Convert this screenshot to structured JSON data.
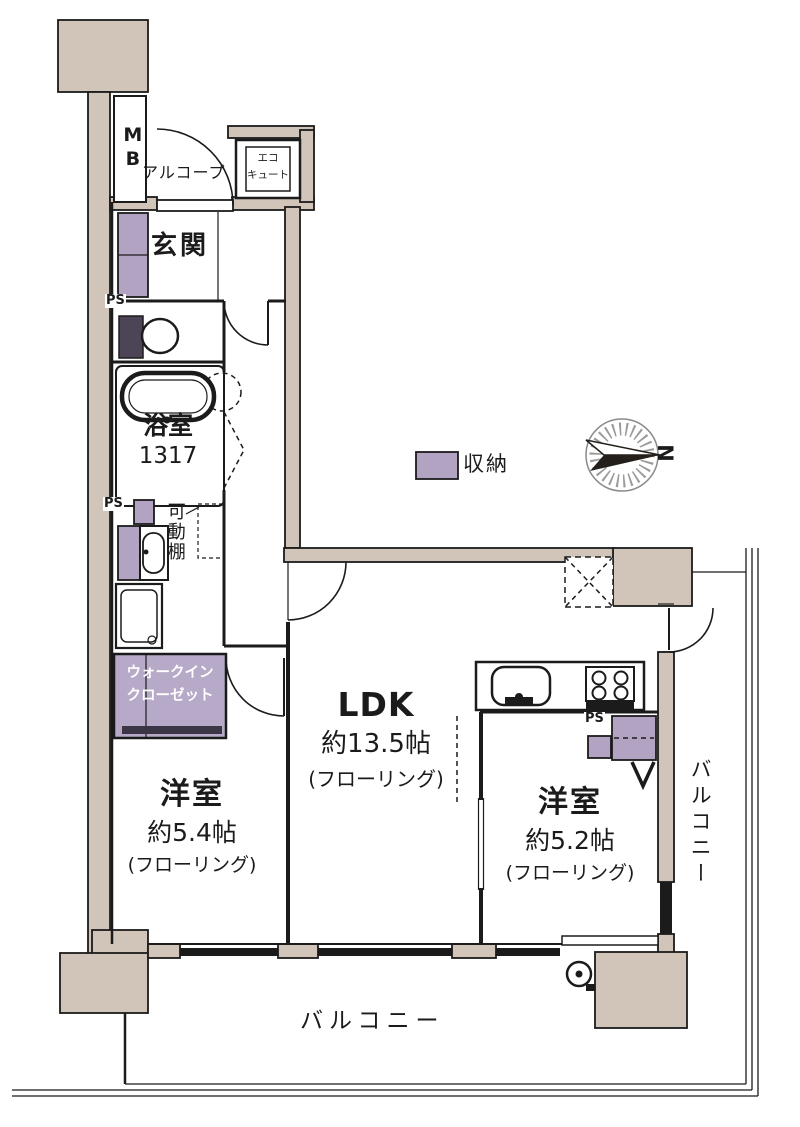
{
  "colors": {
    "wall": "#d1c5b9",
    "storage": "#b2a3c2",
    "wic": "#b7a9c8",
    "line": "#1b1b1b",
    "dark_fixture": "#4e4457"
  },
  "legend": {
    "storage": "収納"
  },
  "compass": {
    "north": "N"
  },
  "labels": {
    "mb": "MB",
    "alcove": "アルコープ",
    "ecocute1": "エコ",
    "ecocute2": "キュート",
    "entrance": "玄関",
    "ps": "PS",
    "bath_name": "浴室",
    "bath_size": "1317",
    "shelf": "可動棚",
    "wic1": "ウォークイン",
    "wic2": "クローゼット",
    "balcony": "バルコニー"
  },
  "rooms": {
    "bedroom1": {
      "name": "洋室",
      "size": "約5.4帖",
      "floor": "(フローリング)"
    },
    "ldk": {
      "name": "LDK",
      "size": "約13.5帖",
      "floor": "(フローリング)"
    },
    "bedroom2": {
      "name": "洋室",
      "size": "約5.2帖",
      "floor": "(フローリング)"
    }
  }
}
